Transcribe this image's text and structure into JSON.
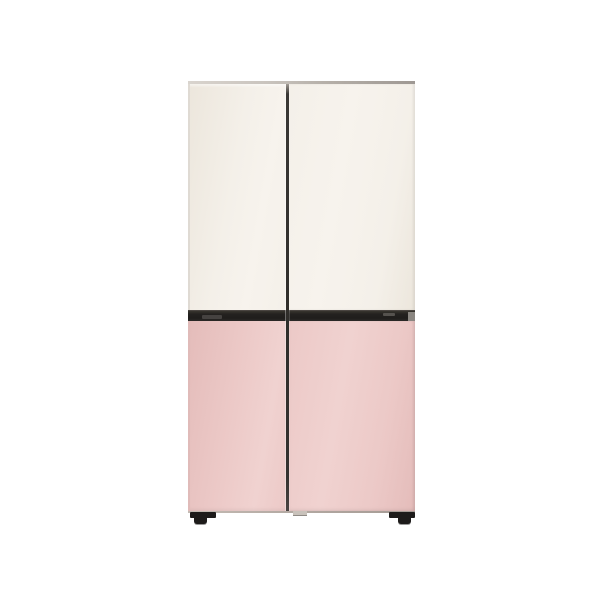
{
  "product": {
    "name": "four-door-refrigerator",
    "description": "Side-by-side four-panel refrigerator product photo: cream upper door panels, pink lower door panels, dark recessed handle strip across the middle, thin metallic top and bottom edges, and small dark wheel feet, centered on a white background"
  },
  "colors": {
    "bg": "#ffffff",
    "cream": "#f4f0e9",
    "cream-light": "#f7f3ed",
    "cream-dark": "#ece6dc",
    "pink": "#ecc9c7",
    "pink-light": "#f0d2d0",
    "pink-dark": "#e4bcba",
    "strip": "#242220",
    "strip-top": "#38352f",
    "recess": "#454240",
    "endcap": "#8a8681",
    "gap": "#2f2d2a",
    "gap-top": "#a39d97",
    "top-cap": "#b6b0a9",
    "bottom-cap": "#b2a8a1",
    "foot": "#1d1b1a",
    "center-foot": "#c9c2bb"
  }
}
